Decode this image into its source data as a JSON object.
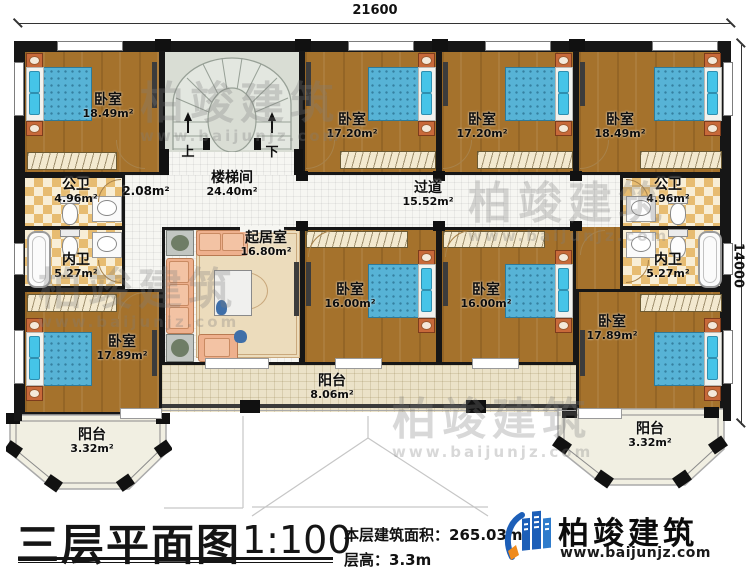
{
  "dimensions": {
    "top": "21600",
    "right": "14000"
  },
  "rooms": {
    "bedroom_top_left": {
      "name": "卧室",
      "area": "18.49m²"
    },
    "bedroom_top_mid1": {
      "name": "卧室",
      "area": "17.20m²"
    },
    "bedroom_top_mid2": {
      "name": "卧室",
      "area": "17.20m²"
    },
    "bedroom_top_right": {
      "name": "卧室",
      "area": "18.49m²"
    },
    "stairwell": {
      "name": "楼梯间",
      "area": "24.40m²"
    },
    "small_hall": {
      "area": "2.08m²"
    },
    "corridor": {
      "name": "过道",
      "area": "15.52m²"
    },
    "living_room": {
      "name": "起居室",
      "area": "16.80m²"
    },
    "public_bath_left": {
      "name": "公卫",
      "area": "4.96m²"
    },
    "private_bath_left": {
      "name": "内卫",
      "area": "5.27m²"
    },
    "public_bath_right": {
      "name": "公卫",
      "area": "4.96m²"
    },
    "private_bath_right": {
      "name": "内卫",
      "area": "5.27m²"
    },
    "bedroom_mid1": {
      "name": "卧室",
      "area": "16.00m²"
    },
    "bedroom_mid2": {
      "name": "卧室",
      "area": "16.00m²"
    },
    "bedroom_bottom_left": {
      "name": "卧室",
      "area": "17.89m²"
    },
    "bedroom_bottom_right": {
      "name": "卧室",
      "area": "17.89m²"
    },
    "balcony_left": {
      "name": "阳台",
      "area": "3.32m²"
    },
    "balcony_center": {
      "name": "阳台",
      "area": "8.06m²"
    },
    "balcony_right": {
      "name": "阳台",
      "area": "3.32m²"
    }
  },
  "stairs": {
    "up": "上",
    "down": "下"
  },
  "watermark": {
    "text": "柏竣建筑",
    "url": "www.baijunjz.com"
  },
  "footer": {
    "title": "三层平面图",
    "scale": "1:100",
    "area_label": "本层建筑面积：",
    "area_value": "265.03m²",
    "height_label": "层高：",
    "height_value": "3.3m",
    "brand": "柏竣建筑",
    "website": "www.baijunjz.com"
  },
  "colors": {
    "wall": "#161616",
    "wood_floor": "#a5722c",
    "bed_blue": "#57b3d6",
    "brand_blue": "#1d5fb8",
    "brand_orange": "#ef8a1c"
  }
}
